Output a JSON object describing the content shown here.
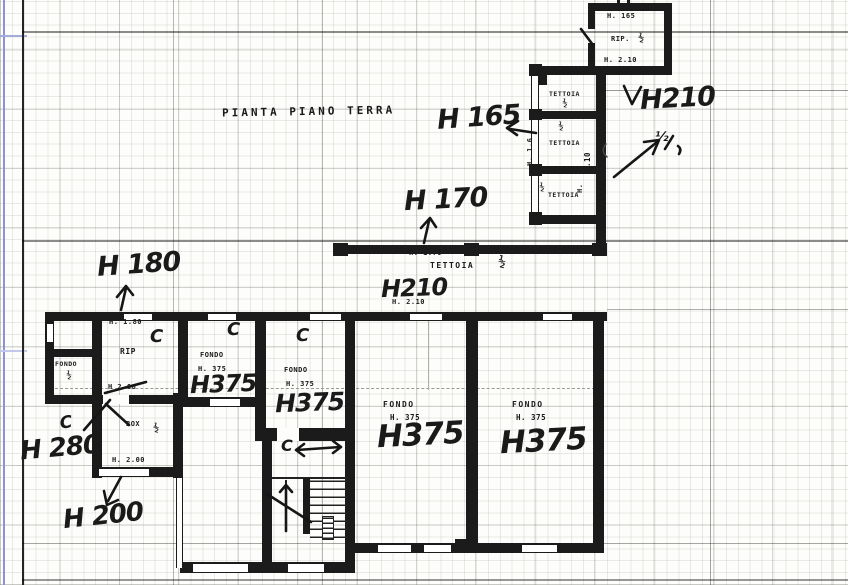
{
  "plan": {
    "title": "PIANTA PIANO TERRA"
  },
  "hand": {
    "h180": "H 180",
    "h165": "H 165",
    "h170": "H 170",
    "h210_ne": "H210",
    "h210_band": "H210",
    "h280": "H 280",
    "h200": "H 200",
    "h375_1": "H375",
    "h375_2": "H375",
    "h375_3": "H375",
    "h375_4": "H375",
    "c1": "C",
    "c2": "C",
    "c3": "C",
    "c_h280": "C",
    "c_stairs": "C",
    "half_ne": "½"
  },
  "printed": {
    "shed_h_top": "H. 165",
    "shed_name": "RIP.",
    "shed_half": "½",
    "shed_h_bottom": "H. 2.10",
    "t1_name": "TETTOIA",
    "t1_half": "½",
    "t2_name": "TETTOIA",
    "t2_half": "½",
    "t3_name": "TETTOIA",
    "t3_half": "½",
    "t_h_left": "H. 1.6",
    "t_h_right": "2.10",
    "t_h_small": "H.",
    "band_h": "H. 1.70",
    "band_name": "TETTOIA",
    "band_half": "½",
    "band_h2": "H. 2.10",
    "small_name": "FONDO",
    "small_half": "½",
    "rip_h_top": "H. 1.80",
    "rip_name": "RIP",
    "rip_h_door": "H 2.00",
    "f1_name": "FONDO",
    "f1_h": "H. 375",
    "f2_name": "FONDO",
    "f2_h": "H. 375",
    "f3_name": "FONDO",
    "f3_h": "H. 375",
    "f4_name": "FONDO",
    "f4_h": "H. 375",
    "box_name": "BOX",
    "box_half": "½",
    "box_h": "H. 2.00"
  },
  "colors": {
    "ink": "#1b1b1b",
    "paper": "#fdfdfb",
    "margin_blue": "#8a93d6"
  }
}
